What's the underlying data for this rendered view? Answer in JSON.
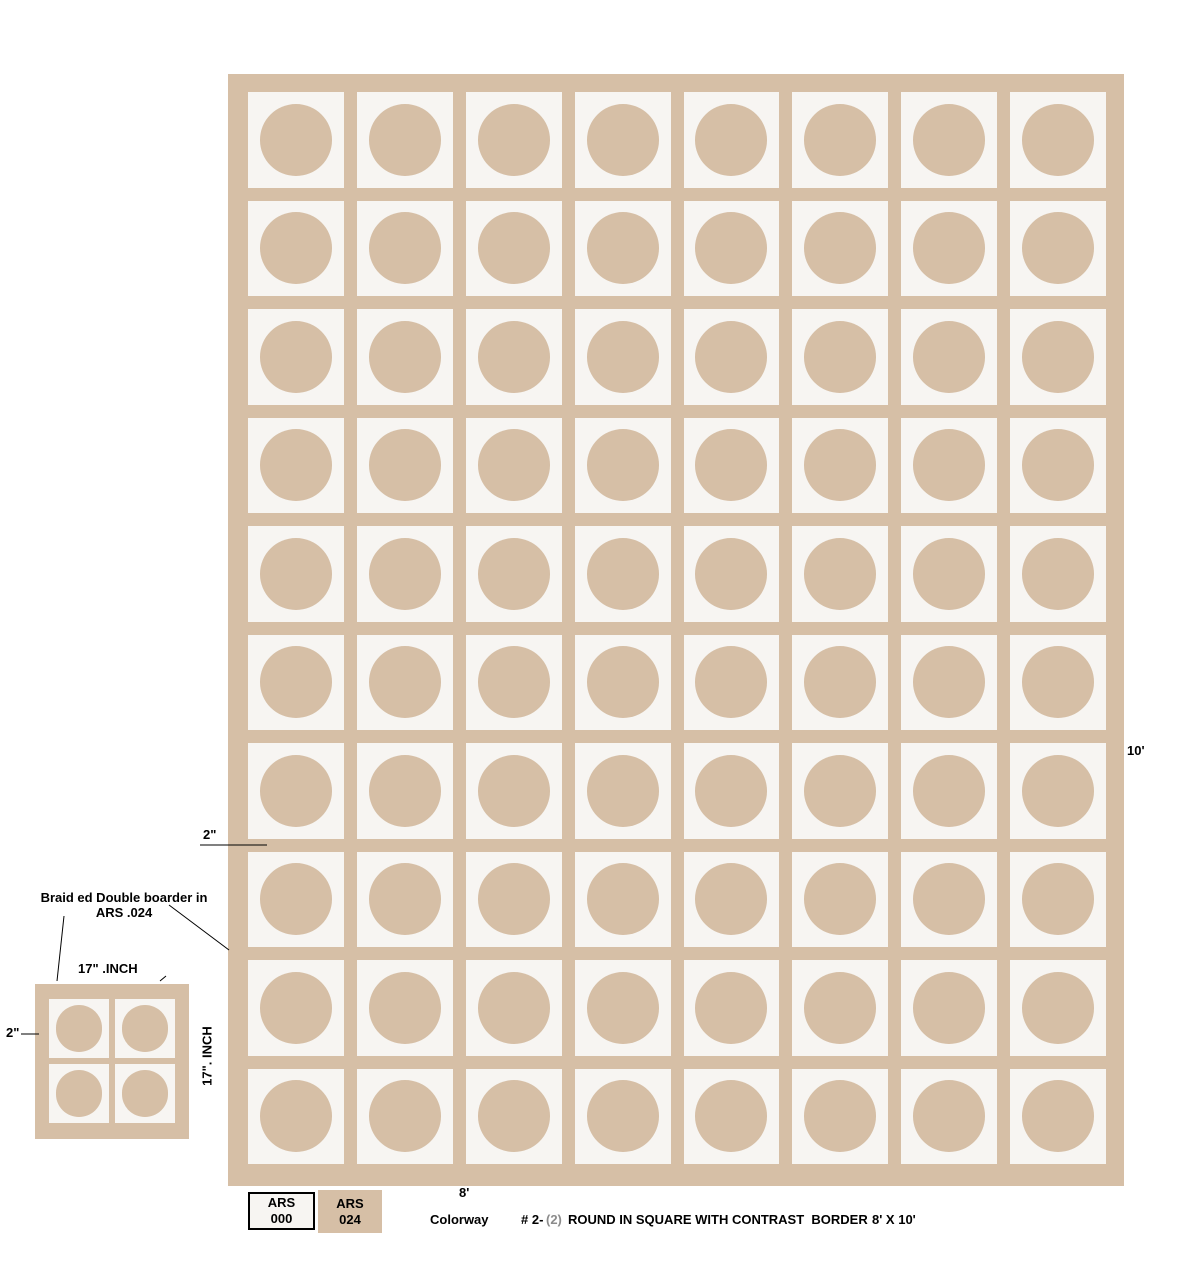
{
  "colors": {
    "tan": "#d6bfa6",
    "square_white": "#f7f5f2",
    "page_background": "#ffffff",
    "text": "#000000",
    "colorway_paren_gray": "#8c8c8c"
  },
  "rug": {
    "rows": 10,
    "cols": 8
  },
  "swatch": {
    "rows": 2,
    "cols": 2
  },
  "annotations": {
    "border_note_line1": "Braid ed Double boarder in",
    "border_note_line2": "ARS .024",
    "width_inches_label": "17\" .INCH",
    "height_inches_label": "17\". INCH",
    "border_width_label_top": "2\"",
    "border_width_label_left": "2\"",
    "rug_height_label": "10'",
    "rug_width_label": "8'"
  },
  "legend": {
    "swatches": [
      {
        "line1": "ARS",
        "line2": "000"
      },
      {
        "line1": "ARS",
        "line2": "024"
      }
    ]
  },
  "caption": {
    "colorway_label": "Colorway",
    "colorway_number": "# 2-",
    "colorway_paren": "(2)",
    "title": "ROUND IN SQUARE WITH CONTRAST  BORDER",
    "size": "8' X 10'"
  }
}
